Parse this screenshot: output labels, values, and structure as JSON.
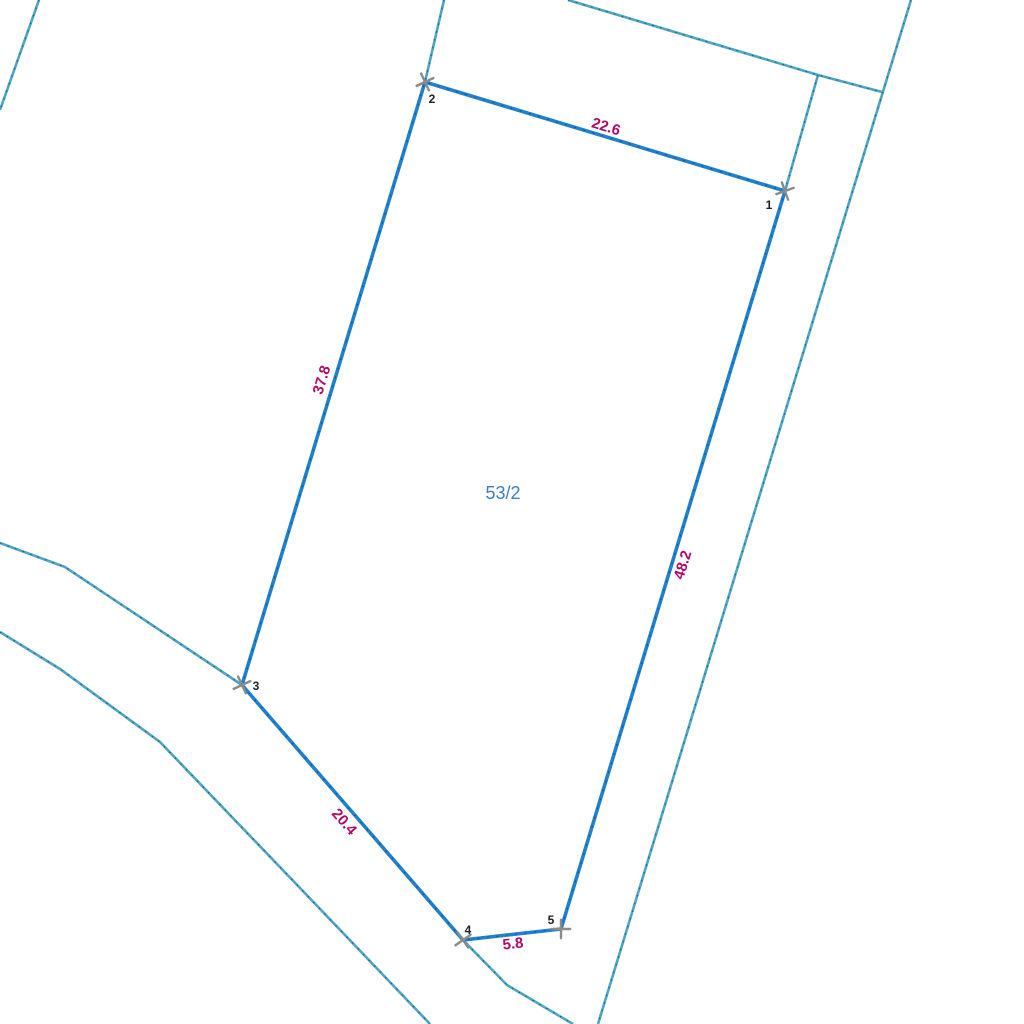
{
  "map": {
    "colors": {
      "parcel_boundary": "#2080cc",
      "parcel_boundary_speckle": "#0d4f8a",
      "cadastral_line": "#4da4c4",
      "cadastral_speckle": "#17586e",
      "measurement_text": "#b20a64",
      "parcel_label_text": "#3c7dc3",
      "vertex_label_text": "#222222",
      "marker": "#8b8b8b",
      "background": "#ffffff"
    },
    "parcel": {
      "label": "53/2",
      "label_pos": {
        "x": 503,
        "y": 493
      },
      "vertices": [
        {
          "id": "1",
          "x": 785,
          "y": 191,
          "label_x": 769,
          "label_y": 209,
          "marker_rot": 25
        },
        {
          "id": "2",
          "x": 425,
          "y": 82,
          "label_x": 432,
          "label_y": 103,
          "marker_rot": 20
        },
        {
          "id": "3",
          "x": 242,
          "y": 685,
          "label_x": 256,
          "label_y": 690,
          "marker_rot": 20
        },
        {
          "id": "4",
          "x": 463,
          "y": 940,
          "label_x": 468,
          "label_y": 934,
          "marker_rot": 10
        },
        {
          "id": "5",
          "x": 561,
          "y": 929,
          "label_x": 551,
          "label_y": 924,
          "marker_rot": 45
        }
      ],
      "edges": [
        {
          "from": "2",
          "to": "1",
          "length": "22.6",
          "label_x": 606,
          "label_y": 127,
          "angle": 17
        },
        {
          "from": "2",
          "to": "3",
          "length": "37.8",
          "label_x": 322,
          "label_y": 380,
          "angle": -73
        },
        {
          "from": "1",
          "to": "5",
          "length": "48.2",
          "label_x": 683,
          "label_y": 565,
          "angle": -73
        },
        {
          "from": "3",
          "to": "4",
          "length": "20.4",
          "label_x": 344,
          "label_y": 822,
          "angle": 49
        },
        {
          "from": "4",
          "to": "5",
          "length": "5.8",
          "label_x": 513,
          "label_y": 944,
          "angle": -6
        }
      ]
    },
    "background_lines": [
      {
        "name": "cadastral-line-topleft",
        "points": [
          [
            39,
            0
          ],
          [
            0,
            110
          ]
        ]
      },
      {
        "name": "cadastral-line-above-v2",
        "points": [
          [
            444,
            0
          ],
          [
            425,
            82
          ]
        ]
      },
      {
        "name": "cadastral-line-diagonal",
        "points": [
          [
            568,
            0
          ],
          [
            818,
            75
          ],
          [
            882,
            92
          ]
        ]
      },
      {
        "name": "cadastral-line-branch-v1",
        "points": [
          [
            818,
            75
          ],
          [
            785,
            191
          ]
        ]
      },
      {
        "name": "cadastral-line-right",
        "points": [
          [
            911,
            0
          ],
          [
            598,
            1024
          ]
        ]
      },
      {
        "name": "cadastral-road-upper",
        "points": [
          [
            0,
            543
          ],
          [
            65,
            567
          ],
          [
            242,
            685
          ],
          [
            463,
            940
          ],
          [
            507,
            985
          ],
          [
            573,
            1024
          ]
        ]
      },
      {
        "name": "cadastral-road-lower",
        "points": [
          [
            0,
            632
          ],
          [
            60,
            669
          ],
          [
            160,
            742
          ],
          [
            300,
            888
          ],
          [
            430,
            1024
          ]
        ]
      }
    ]
  }
}
